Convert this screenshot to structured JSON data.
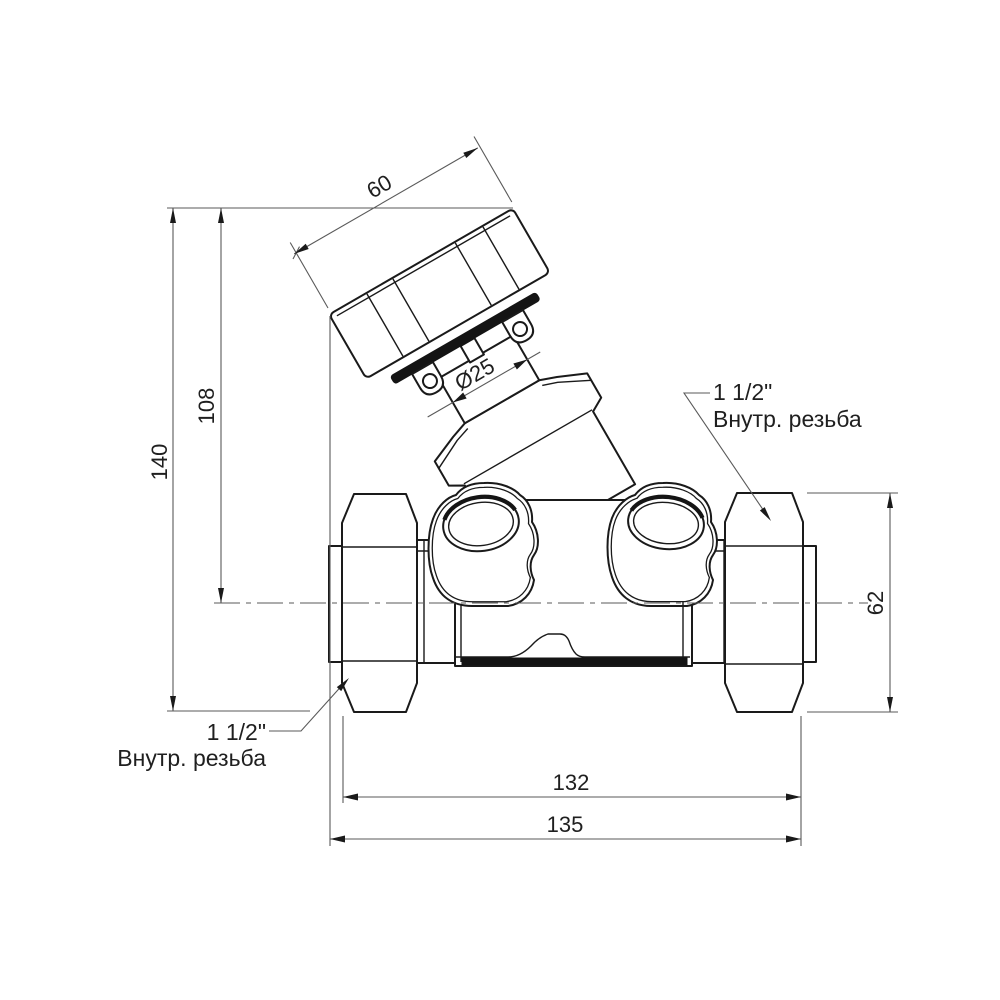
{
  "drawing": {
    "title": "Balancing valve with actuator head — dimensioned technical drawing",
    "dimensions": {
      "knob_width": "60",
      "stem_diameter": "Ø25",
      "center_height": "108",
      "total_height": "140",
      "union_nut_size": "62",
      "body_length": "132",
      "overall_length": "135"
    },
    "labels": {
      "left_port": {
        "size": "1 1/2\"",
        "thread": "Внутр. резьба"
      },
      "right_port": {
        "size": "1 1/2\"",
        "thread": "Внутр. резьба"
      }
    },
    "colors": {
      "line": "#1a1a1a",
      "dimension_line": "#5a5a5a",
      "background": "#ffffff"
    }
  }
}
